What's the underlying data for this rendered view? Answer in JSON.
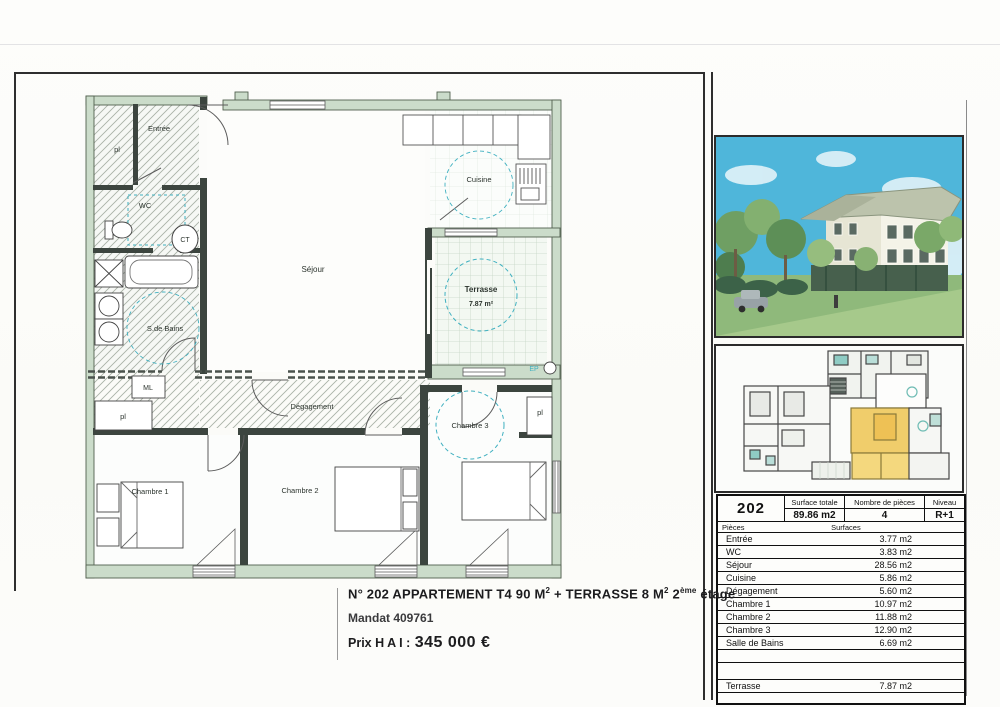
{
  "floor_plan": {
    "labels": {
      "pl_entree": "pl",
      "entree": "Entrée",
      "wc": "WC",
      "ct": "CT",
      "salle_de_bains": "S.de Bains",
      "ml": "ML",
      "pl_corridor": "pl",
      "sejour": "Séjour",
      "cuisine": "Cuisine",
      "terrasse_name": "Terrasse",
      "terrasse_area": "7.87 m²",
      "degagement": "Dégagement",
      "chambre1": "Chambre 1",
      "chambre2": "Chambre 2",
      "chambre3": "Chambre 3",
      "pl_chambre3": "pl",
      "ep": "EP"
    },
    "colors": {
      "exterior_wall": "#cbdcca",
      "interior_wall": "#3c453f",
      "dashed_marks": "#3fb0c0"
    }
  },
  "listing": {
    "title_part1": "N° 202  APPARTEMENT  T4  90 M",
    "title_sup1": "2",
    "title_part2": " + TERRASSE  8 M",
    "title_sup2": "2",
    "title_part3": "  2",
    "title_sup3": "ème",
    "title_part4": " étage",
    "mandat": "Mandat 409761",
    "price_label": "Prix H A I :",
    "price_value": "345 000 €"
  },
  "summary": {
    "unit_number": "202",
    "surface_totale_label": "Surface totale",
    "surface_totale": "89.86 m2",
    "nb_pieces_label": "Nombre de pièces",
    "nb_pieces": "4",
    "niveau_label": "Niveau",
    "niveau": "R+1",
    "col_pieces": "Pièces",
    "col_surfaces": "Surfaces",
    "rows": [
      {
        "label": "Entrée",
        "value": "3.77 m2"
      },
      {
        "label": "WC",
        "value": "3.83 m2"
      },
      {
        "label": "Séjour",
        "value": "28.56 m2"
      },
      {
        "label": "Cuisine",
        "value": "5.86 m2"
      },
      {
        "label": "Dégagement",
        "value": "5.60 m2"
      },
      {
        "label": "Chambre 1",
        "value": "10.97 m2"
      },
      {
        "label": "Chambre 2",
        "value": "11.88 m2"
      },
      {
        "label": "Chambre 3",
        "value": "12.90 m2"
      },
      {
        "label": "Salle de Bains",
        "value": "6.69 m2"
      },
      {
        "label": "",
        "value": ""
      },
      {
        "label": "",
        "value": ""
      },
      {
        "label": "Terrasse",
        "value": "7.87 m2"
      },
      {
        "label": "",
        "value": ""
      }
    ]
  }
}
